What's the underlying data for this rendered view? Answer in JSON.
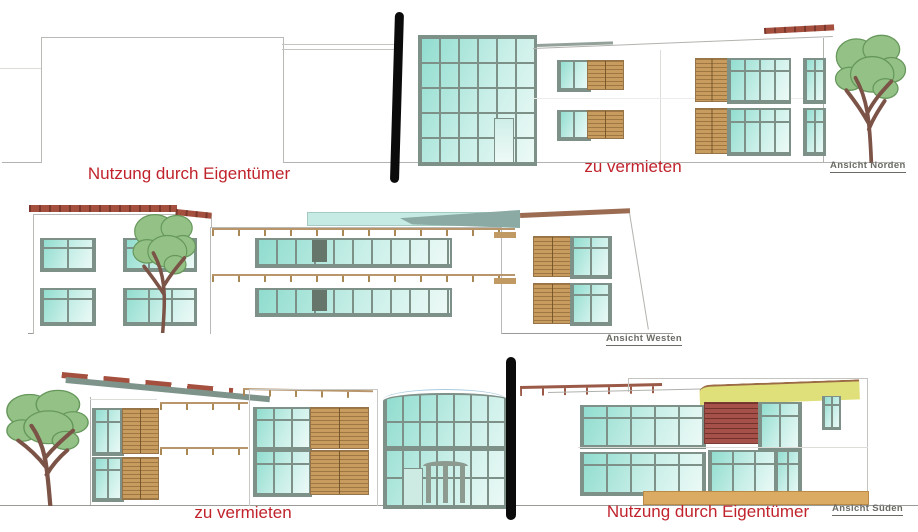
{
  "annotations": {
    "north": {
      "owner_label": "Nutzung durch Eigentümer",
      "rent_label": "zu vermieten",
      "caption": "Ansicht Norden"
    },
    "west": {
      "caption": "Ansicht Westen"
    },
    "south": {
      "rent_label": "zu vermieten",
      "owner_label": "Nutzung durch Eigentümer",
      "caption": "Ansicht Süden"
    }
  },
  "colors": {
    "annotation_red": "#c0232c",
    "caption_gray": "#6b6b66",
    "glass_teal": "#8fdcce",
    "mullion_green_gray": "#7e9189",
    "louver_tan": "#c79c5e",
    "brick_red": "#a5514a",
    "roof_tile_red": "#a5503f",
    "roof_teal": "#7e948b",
    "accent_yellow": "#e0e07a",
    "base_tan": "#dcab63",
    "divider_bar_black": "#0b0b0b"
  }
}
